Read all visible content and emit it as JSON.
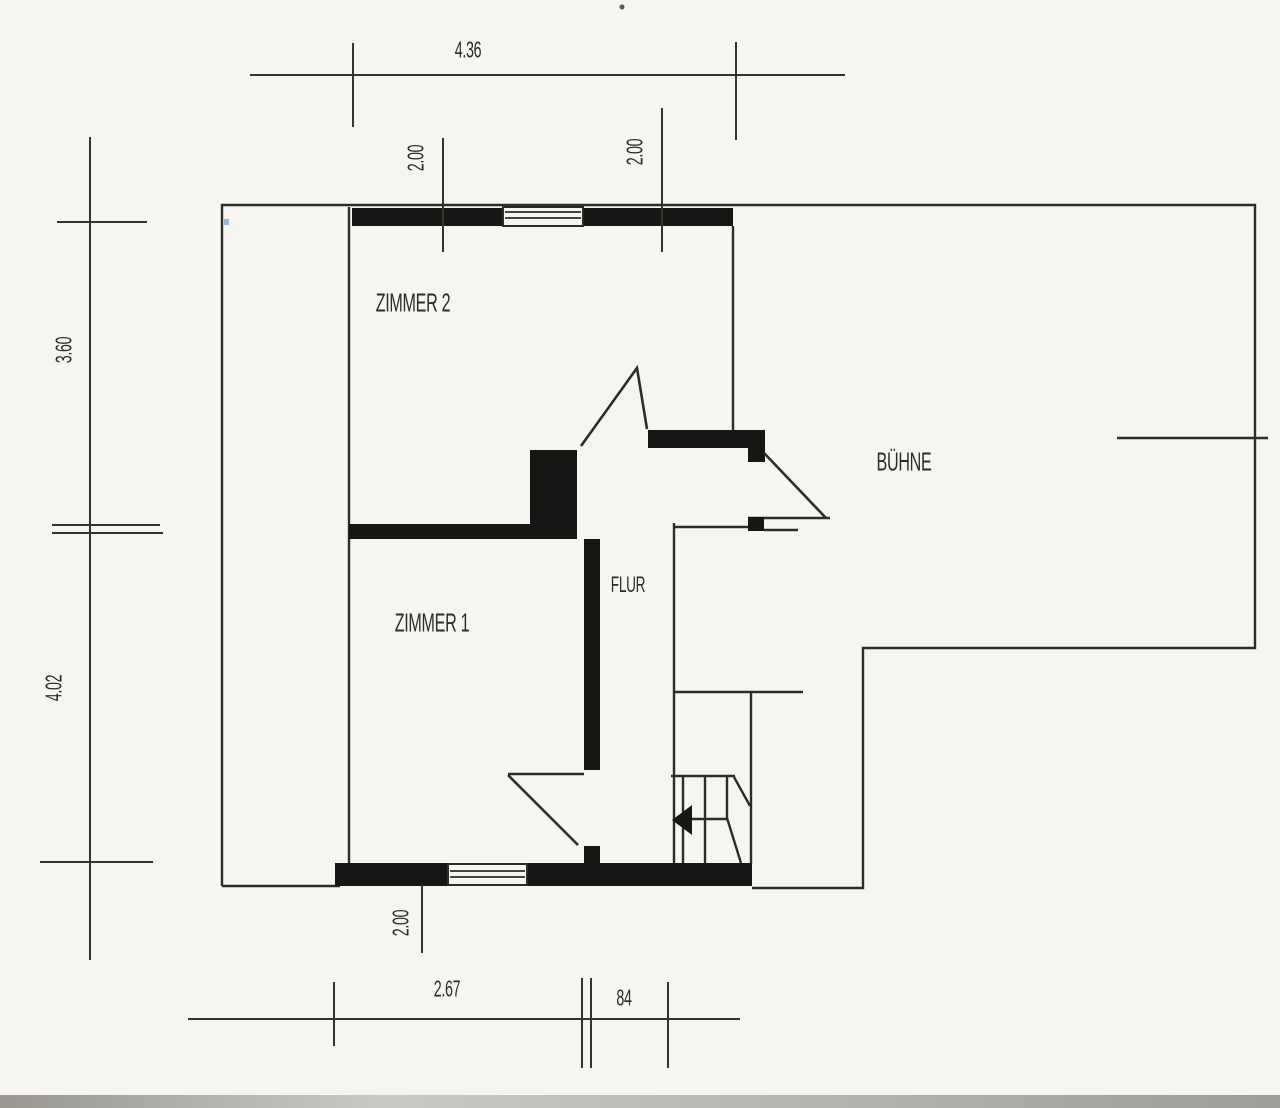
{
  "plan": {
    "type": "floor-plan-scan",
    "rooms": {
      "zimmer2": "ZIMMER 2",
      "zimmer1": "ZIMMER 1",
      "flur": "FLUR",
      "buehne": "BÜHNE"
    },
    "dimensions": {
      "top_width": "4.36",
      "top_window_left": "2.00",
      "top_window_right": "2.00",
      "left_upper": "3.60",
      "left_lower": "4.02",
      "bottom_window": "2.00",
      "bottom_left": "2.67",
      "bottom_right": "84"
    },
    "features": {
      "stairs": "winder-stair-with-direction-arrow",
      "windows": 2,
      "doors": 3
    }
  },
  "colors": {
    "background": "#f6f5f1",
    "ink": "#2e2c28",
    "wall": "#171614",
    "scan_edge": "#9a9994",
    "corner_mark": "#6f9fd8"
  }
}
